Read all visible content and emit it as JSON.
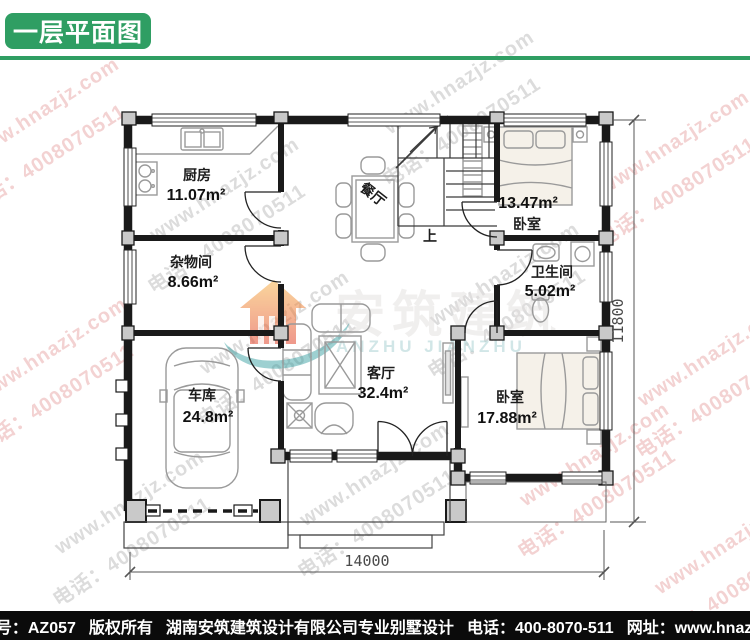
{
  "header": {
    "title": "一层平面图"
  },
  "plan": {
    "rooms": {
      "kitchen": {
        "name": "厨房",
        "area": "11.07m²"
      },
      "dining": {
        "name": "餐厅"
      },
      "bedroom_top": {
        "name": "卧室",
        "area": "13.47m²"
      },
      "storage": {
        "name": "杂物间",
        "area": "8.66m²"
      },
      "bathroom": {
        "name": "卫生间",
        "area": "5.02m²"
      },
      "garage": {
        "name": "车库",
        "area": "24.8m²"
      },
      "living": {
        "name": "客厅",
        "area": "32.4m²"
      },
      "bedroom_bottom": {
        "name": "卧室",
        "area": "17.88m²"
      }
    },
    "stairs_up_label": "上",
    "dimensions": {
      "width_mm": "14000",
      "height_mm": "11800"
    }
  },
  "watermark": {
    "logo_cn": "安筑建筑",
    "logo_en": "ANZHU JIANZHU",
    "tile_line1": "www.hnazjz.com",
    "tile_line2": "电话：4008070511"
  },
  "footer": {
    "doc_id": "本图编号：AZ057",
    "copyright": "版权所有",
    "company": "湖南安筑建筑设计有限公司专业别墅设计",
    "phone": "电话：400-8070-511",
    "website": "网址：www.hnazjz.com"
  },
  "colors": {
    "accent_green": "#2f9e63",
    "footer_bg": "#0b0b0b",
    "wall": "#1a1a1a"
  }
}
